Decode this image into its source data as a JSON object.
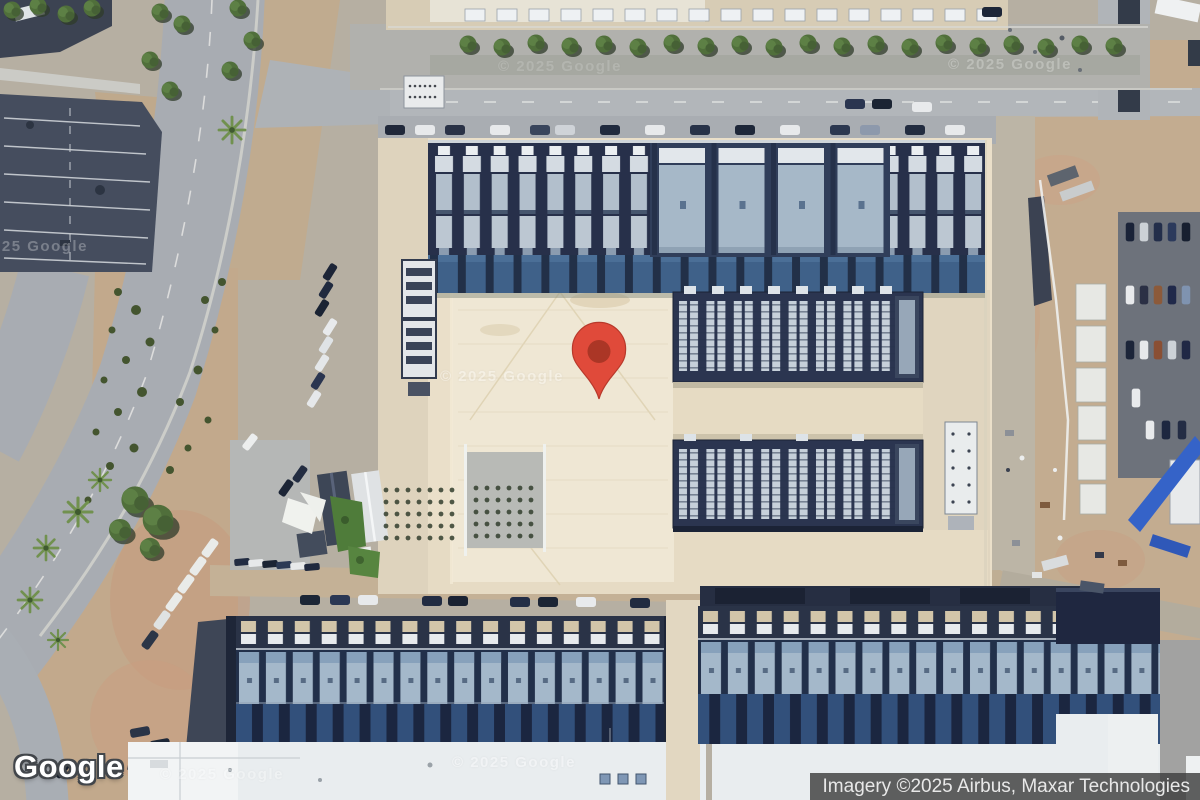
{
  "map": {
    "view_type": "satellite",
    "logo": "Google",
    "watermark": "© 2025 Google",
    "attribution": "Imagery ©2025 Airbus, Maxar Technologies",
    "pin": {
      "icon": "map-pin-icon",
      "color": "#e04a3a",
      "inner_color": "#ab3626",
      "outline_color": "#b8392b"
    },
    "palette": {
      "road": "#a8acb2",
      "dirt": "#c2ab8e",
      "campus_pad": "#eadfc9",
      "building_dark": "#27304a",
      "building_module": "#b2bfcc",
      "roof_white": "#e9edef",
      "vegetation": "#506f3b",
      "parking_lot": "#454d5e"
    }
  }
}
